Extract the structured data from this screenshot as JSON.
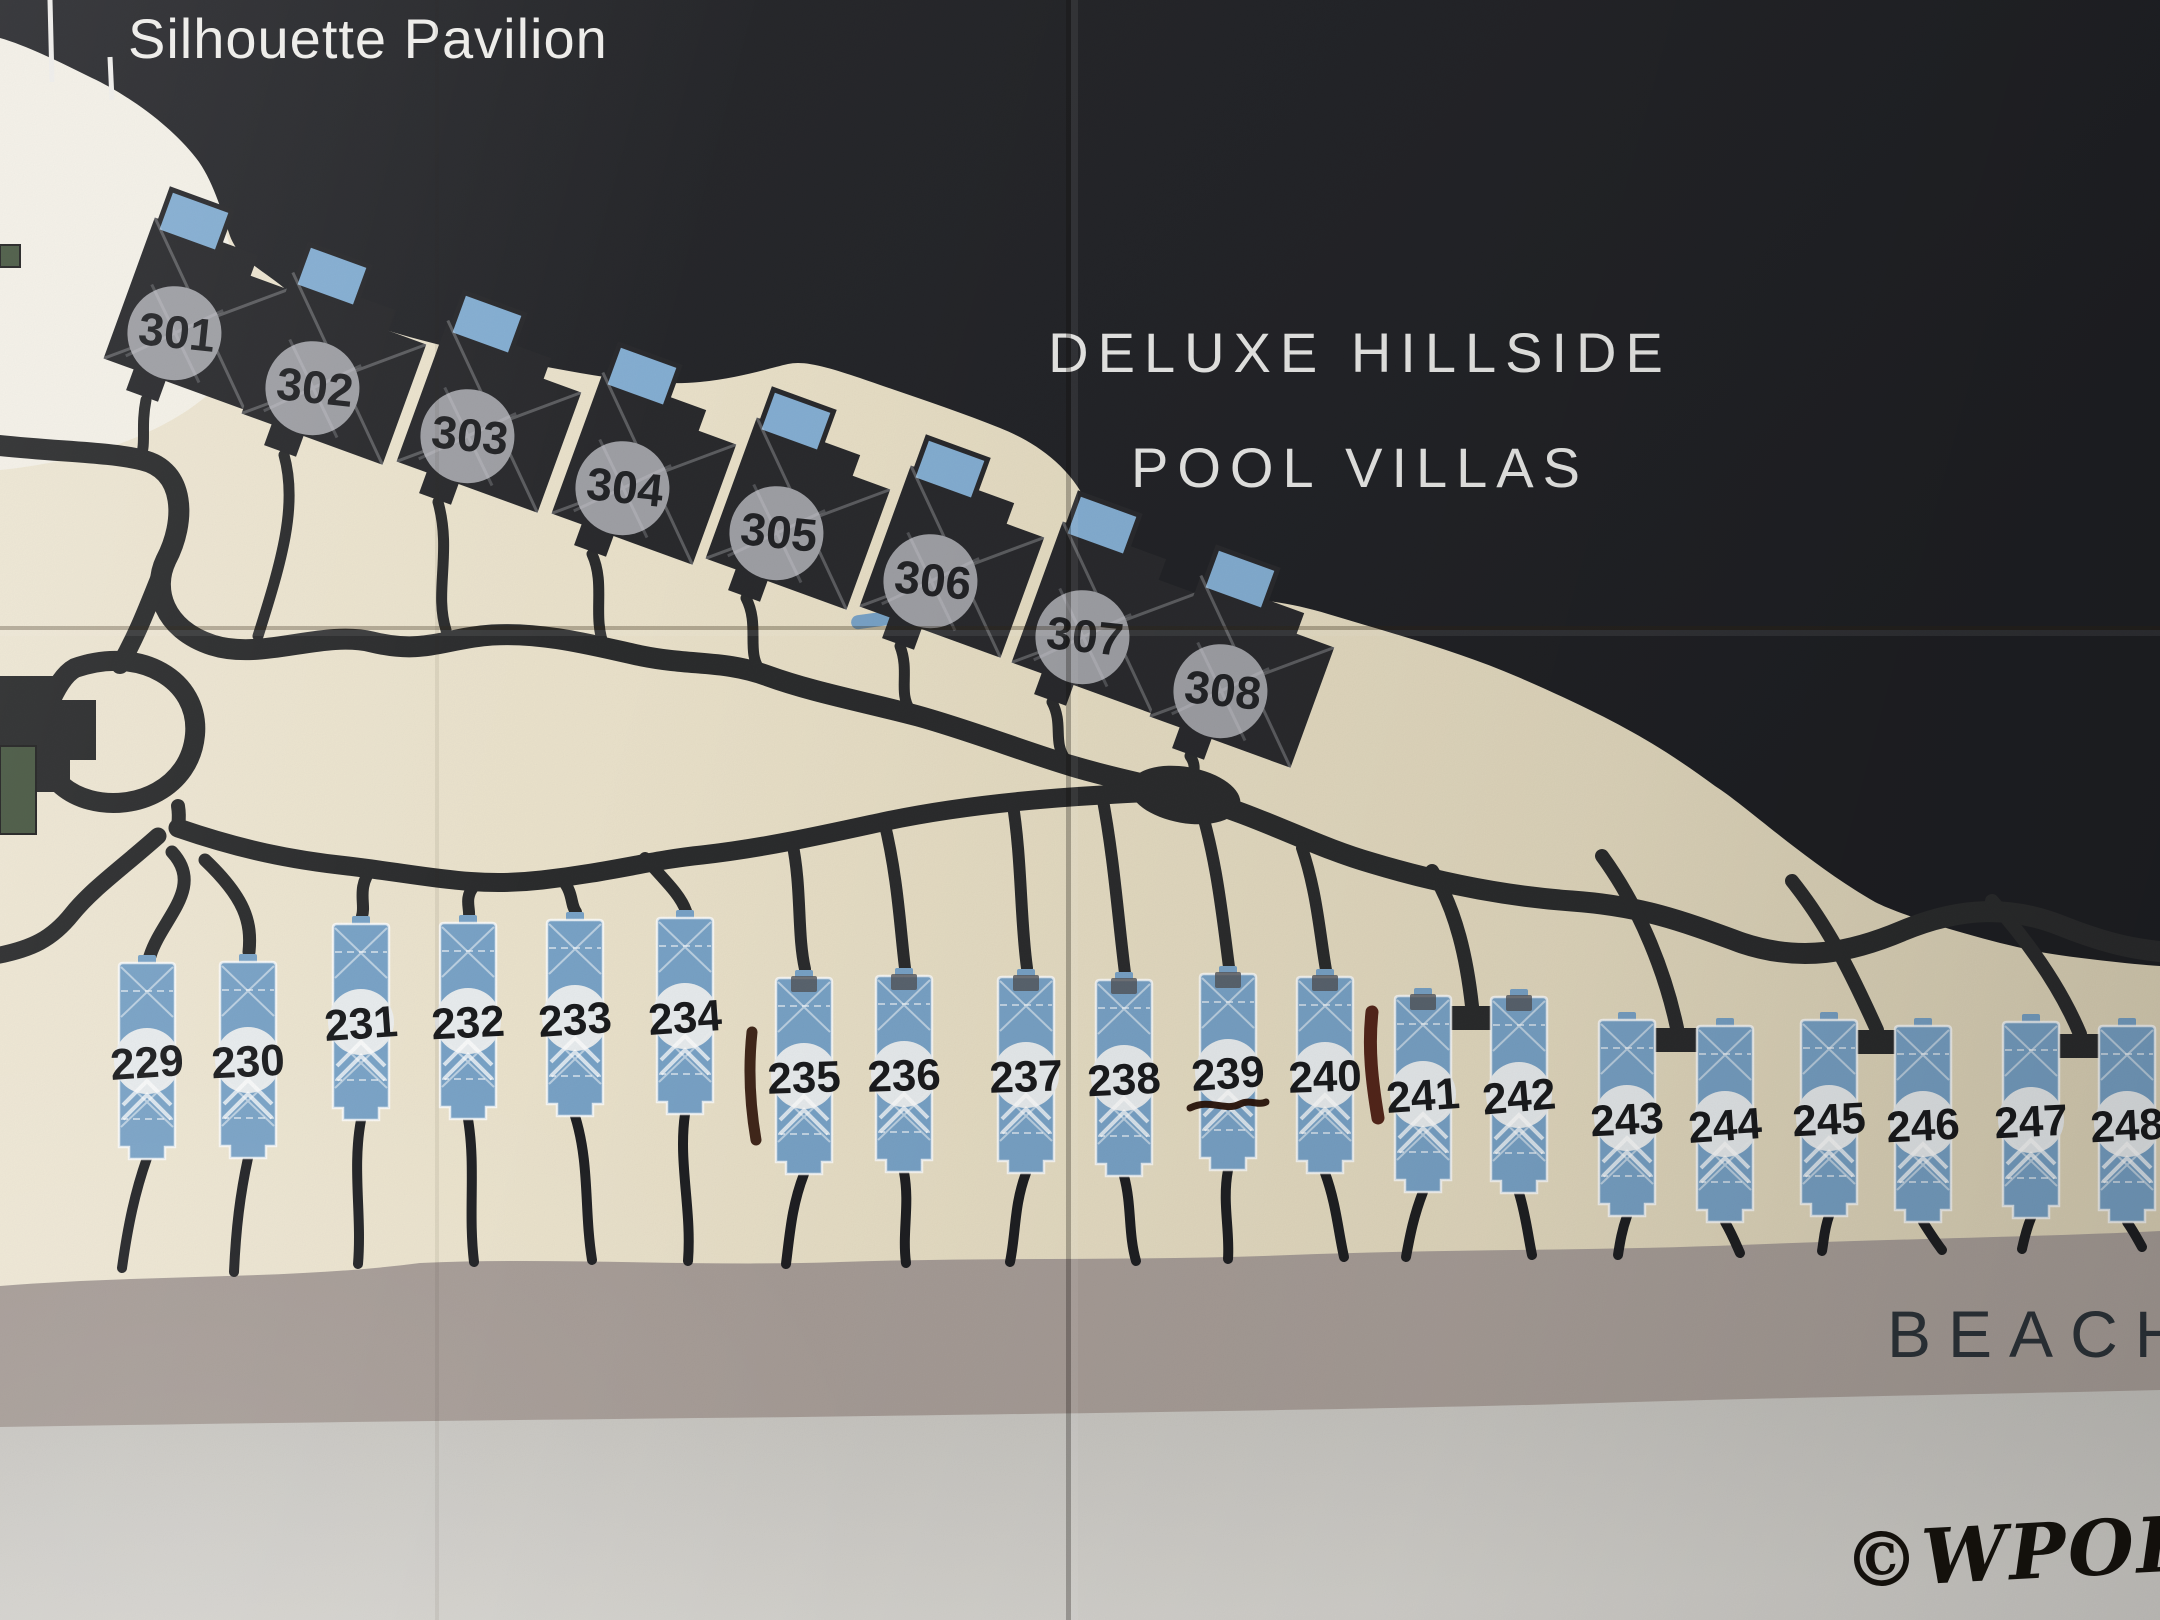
{
  "map": {
    "labels": {
      "pavilion": "Silhouette Pavilion",
      "hillside_line1": "DELUXE HILLSIDE",
      "hillside_line2": "POOL VILLAS",
      "beach": "BEACH",
      "signature": "©WPOH"
    },
    "hillside_villas": [
      {
        "number": "301"
      },
      {
        "number": "302"
      },
      {
        "number": "303"
      },
      {
        "number": "304"
      },
      {
        "number": "305"
      },
      {
        "number": "306"
      },
      {
        "number": "307"
      },
      {
        "number": "308"
      }
    ],
    "beach_villas": [
      {
        "number": "229"
      },
      {
        "number": "230"
      },
      {
        "number": "231"
      },
      {
        "number": "232"
      },
      {
        "number": "233"
      },
      {
        "number": "234"
      },
      {
        "number": "235"
      },
      {
        "number": "236"
      },
      {
        "number": "237"
      },
      {
        "number": "238"
      },
      {
        "number": "239"
      },
      {
        "number": "240"
      },
      {
        "number": "241"
      },
      {
        "number": "242"
      },
      {
        "number": "243"
      },
      {
        "number": "244"
      },
      {
        "number": "245"
      },
      {
        "number": "246"
      },
      {
        "number": "247"
      },
      {
        "number": "248"
      }
    ],
    "annotations": {
      "underlined_villa": "239",
      "ink_marks": [
        "vertical ink stroke left of villa 235",
        "hand-drawn underline below villa 239",
        "vertical ink stroke right of villa 240"
      ]
    },
    "colors": {
      "sand": "#e8dfc5",
      "hill": "#26272b",
      "villa_blue": "#7aa4c8",
      "roof_blue": "#86b0d4",
      "beach_band": "#a89e99",
      "sea": "#cdcbc6",
      "road": "#2c2d2e",
      "ink_dark": "#33180c",
      "ink_red": "#451309",
      "label_light": "#f2f1ee",
      "number_dark": "#1d1e20"
    }
  }
}
